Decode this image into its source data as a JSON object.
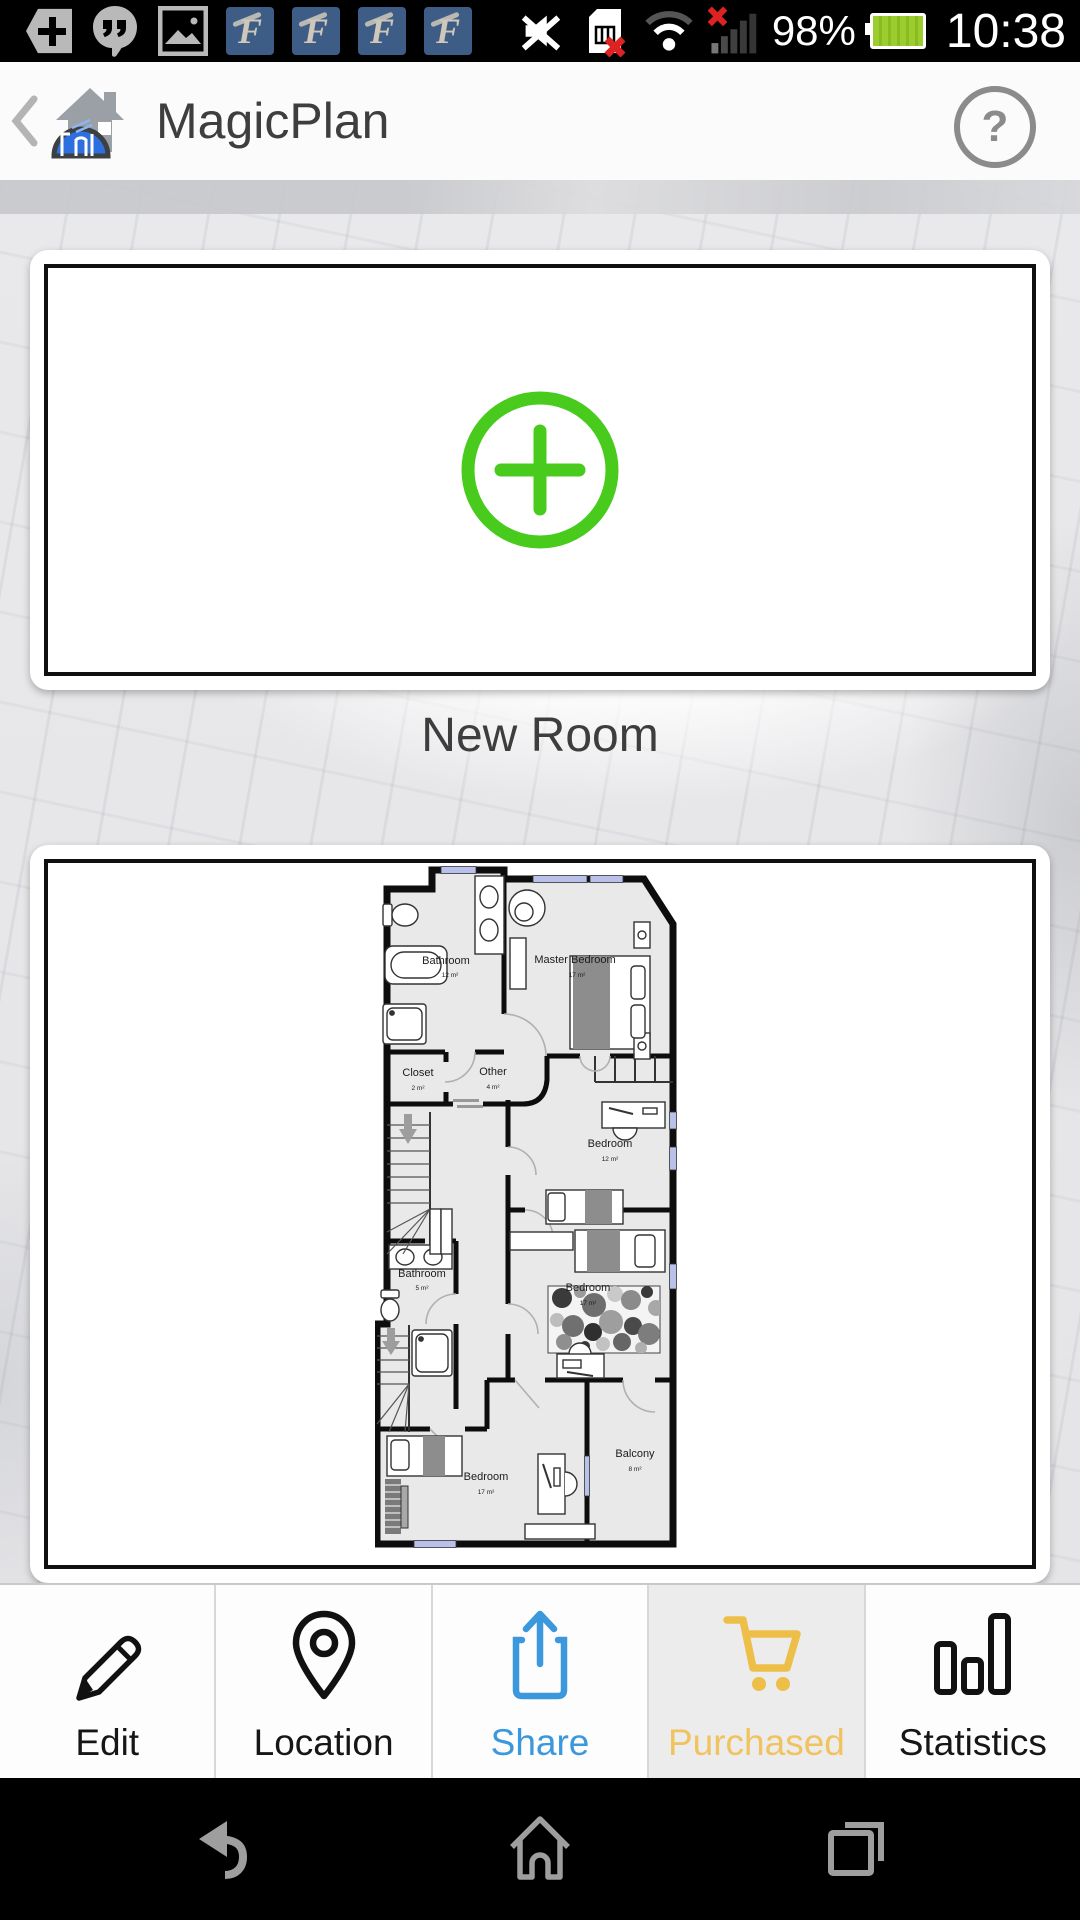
{
  "status_bar": {
    "time": "10:38",
    "battery": "98%",
    "falcon_letter": "F",
    "notification_icons": [
      "plus-badge",
      "hangouts",
      "gallery",
      "falcon",
      "falcon",
      "falcon",
      "falcon"
    ],
    "system_icons": [
      "mute",
      "sim-error",
      "wifi",
      "signal-error"
    ]
  },
  "header": {
    "title": "MagicPlan",
    "help_symbol": "?"
  },
  "main": {
    "new_room_card": {
      "label": "New Room"
    },
    "floor_plan": {
      "rooms": [
        {
          "name": "Bathroom",
          "area": "12 m²"
        },
        {
          "name": "Master Bedroom",
          "area": "17 m²"
        },
        {
          "name": "Closet",
          "area": "2 m²"
        },
        {
          "name": "Other",
          "area": "4 m²"
        },
        {
          "name": "Bedroom",
          "area": "12 m²"
        },
        {
          "name": "Bathroom",
          "area": "5 m²"
        },
        {
          "name": "Bedroom",
          "area": "17 m²"
        },
        {
          "name": "Bedroom",
          "area": "17 m²"
        },
        {
          "name": "Balcony",
          "area": "8 m²"
        }
      ]
    }
  },
  "tab_bar": {
    "tabs": [
      {
        "label": "Edit",
        "active": false
      },
      {
        "label": "Location",
        "active": false
      },
      {
        "label": "Share",
        "active": false
      },
      {
        "label": "Purchased",
        "active": true
      },
      {
        "label": "Statistics",
        "active": false
      }
    ]
  },
  "nav_bar": {
    "icons": [
      "back",
      "home",
      "recents"
    ]
  },
  "colors": {
    "accent_green": "#48cb1c",
    "share_blue": "#3b98dd",
    "purchased_gold": "#eebf48"
  }
}
